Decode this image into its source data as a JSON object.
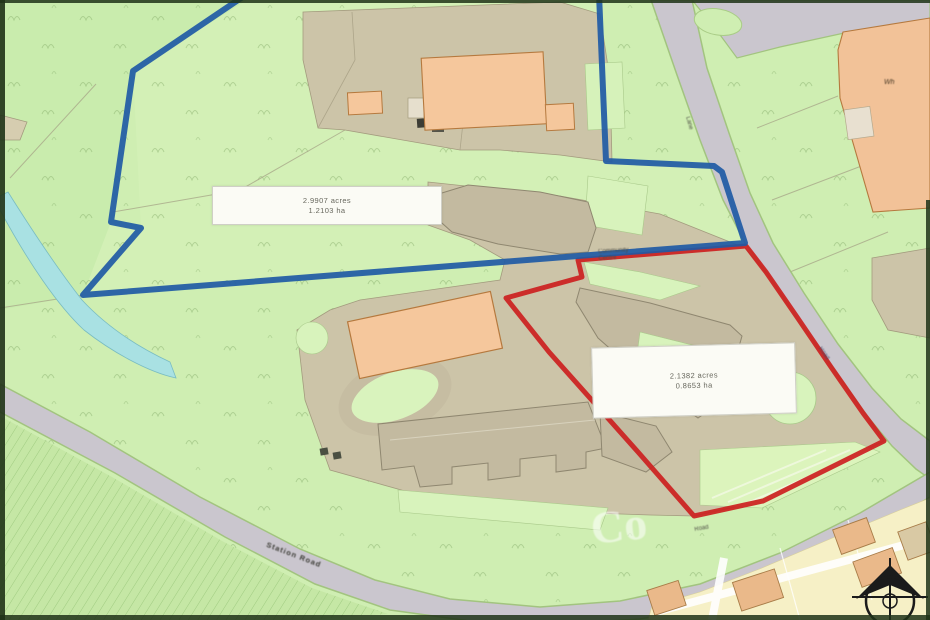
{
  "map": {
    "kind": "land-site-plan",
    "watermark": "Co",
    "plot_blue": {
      "area_acres": "2.9907 acres",
      "area_ha": "1.2103 ha",
      "boundary_color": "#1f5aa5"
    },
    "plot_red": {
      "area_acres": "2.1382 acres",
      "area_ha": "0.8653 ha",
      "boundary_color": "#cc1f1f"
    },
    "labels": {
      "building_line1": "Community",
      "building_line2": "Centre",
      "building_fragment": "Wh",
      "road_top": "Lane",
      "road_right": "Road",
      "road_bottom_left": "Station Road",
      "road_bottom_center": "Road"
    },
    "icons": {
      "north_arrow": "compass-north-arrow"
    },
    "colors": {
      "field_green": "#cfeeb2",
      "lawn_green": "#def6c4",
      "plot_tan": "#ccc4a8",
      "building_tan": "#c3baa0",
      "building_orange": "#f5c79c",
      "road_grey": "#cac6ce",
      "residential_cream": "#f6f0c6",
      "stream_blue": "#a9e1e3",
      "frame_dark": "#1f3317"
    }
  }
}
